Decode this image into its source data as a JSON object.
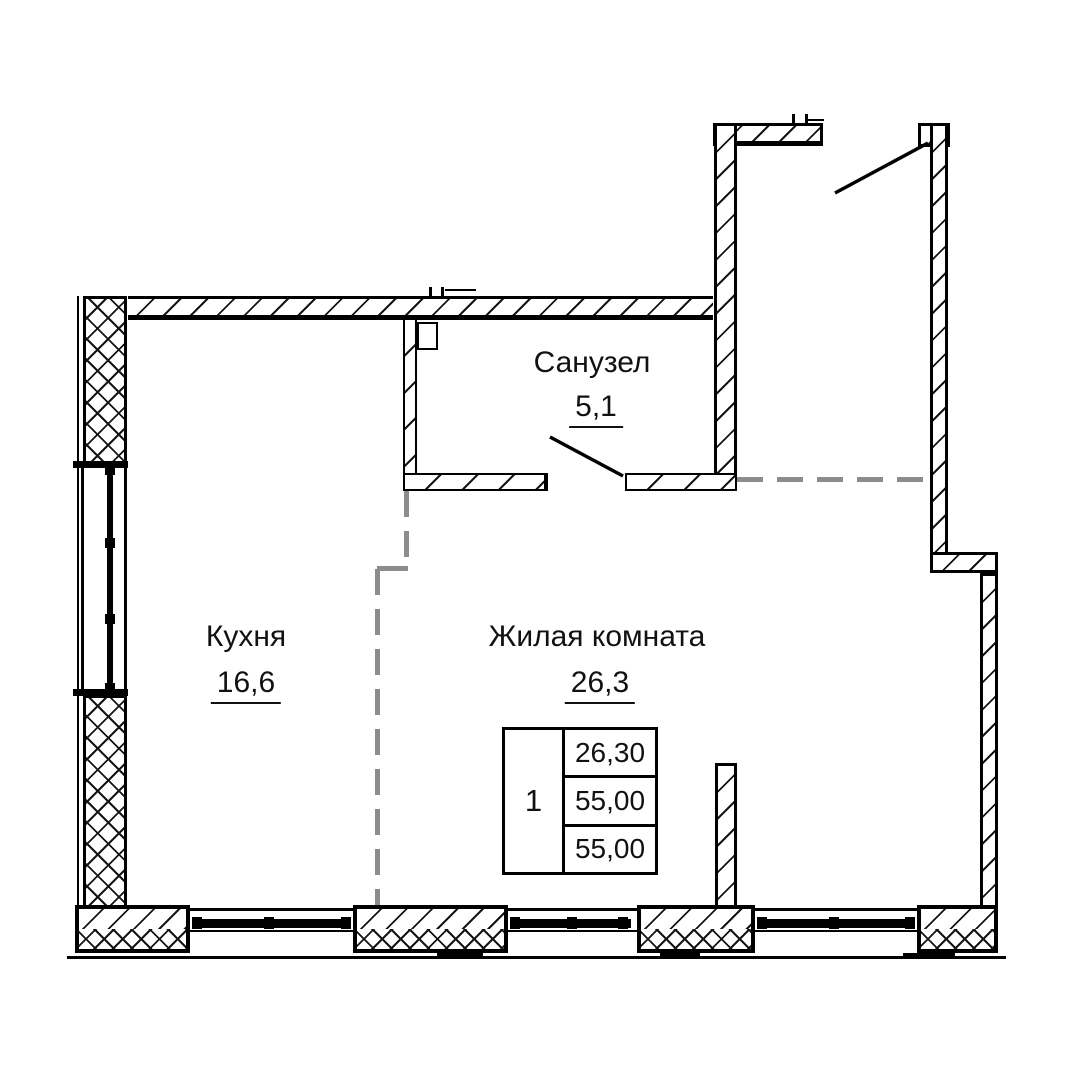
{
  "plan": {
    "rooms": [
      {
        "id": "bathroom",
        "label": "Санузел",
        "area": "5,1"
      },
      {
        "id": "kitchen",
        "label": "Кухня",
        "area": "16,6"
      },
      {
        "id": "living_room",
        "label": "Жилая комната",
        "area": "26,3"
      }
    ],
    "summary_table": {
      "rooms_count": "1",
      "rows": [
        "26,30",
        "55,00",
        "55,00"
      ]
    },
    "colors": {
      "wall": "#000000",
      "zone_divider": "#8c8c8c",
      "background": "#ffffff"
    }
  }
}
